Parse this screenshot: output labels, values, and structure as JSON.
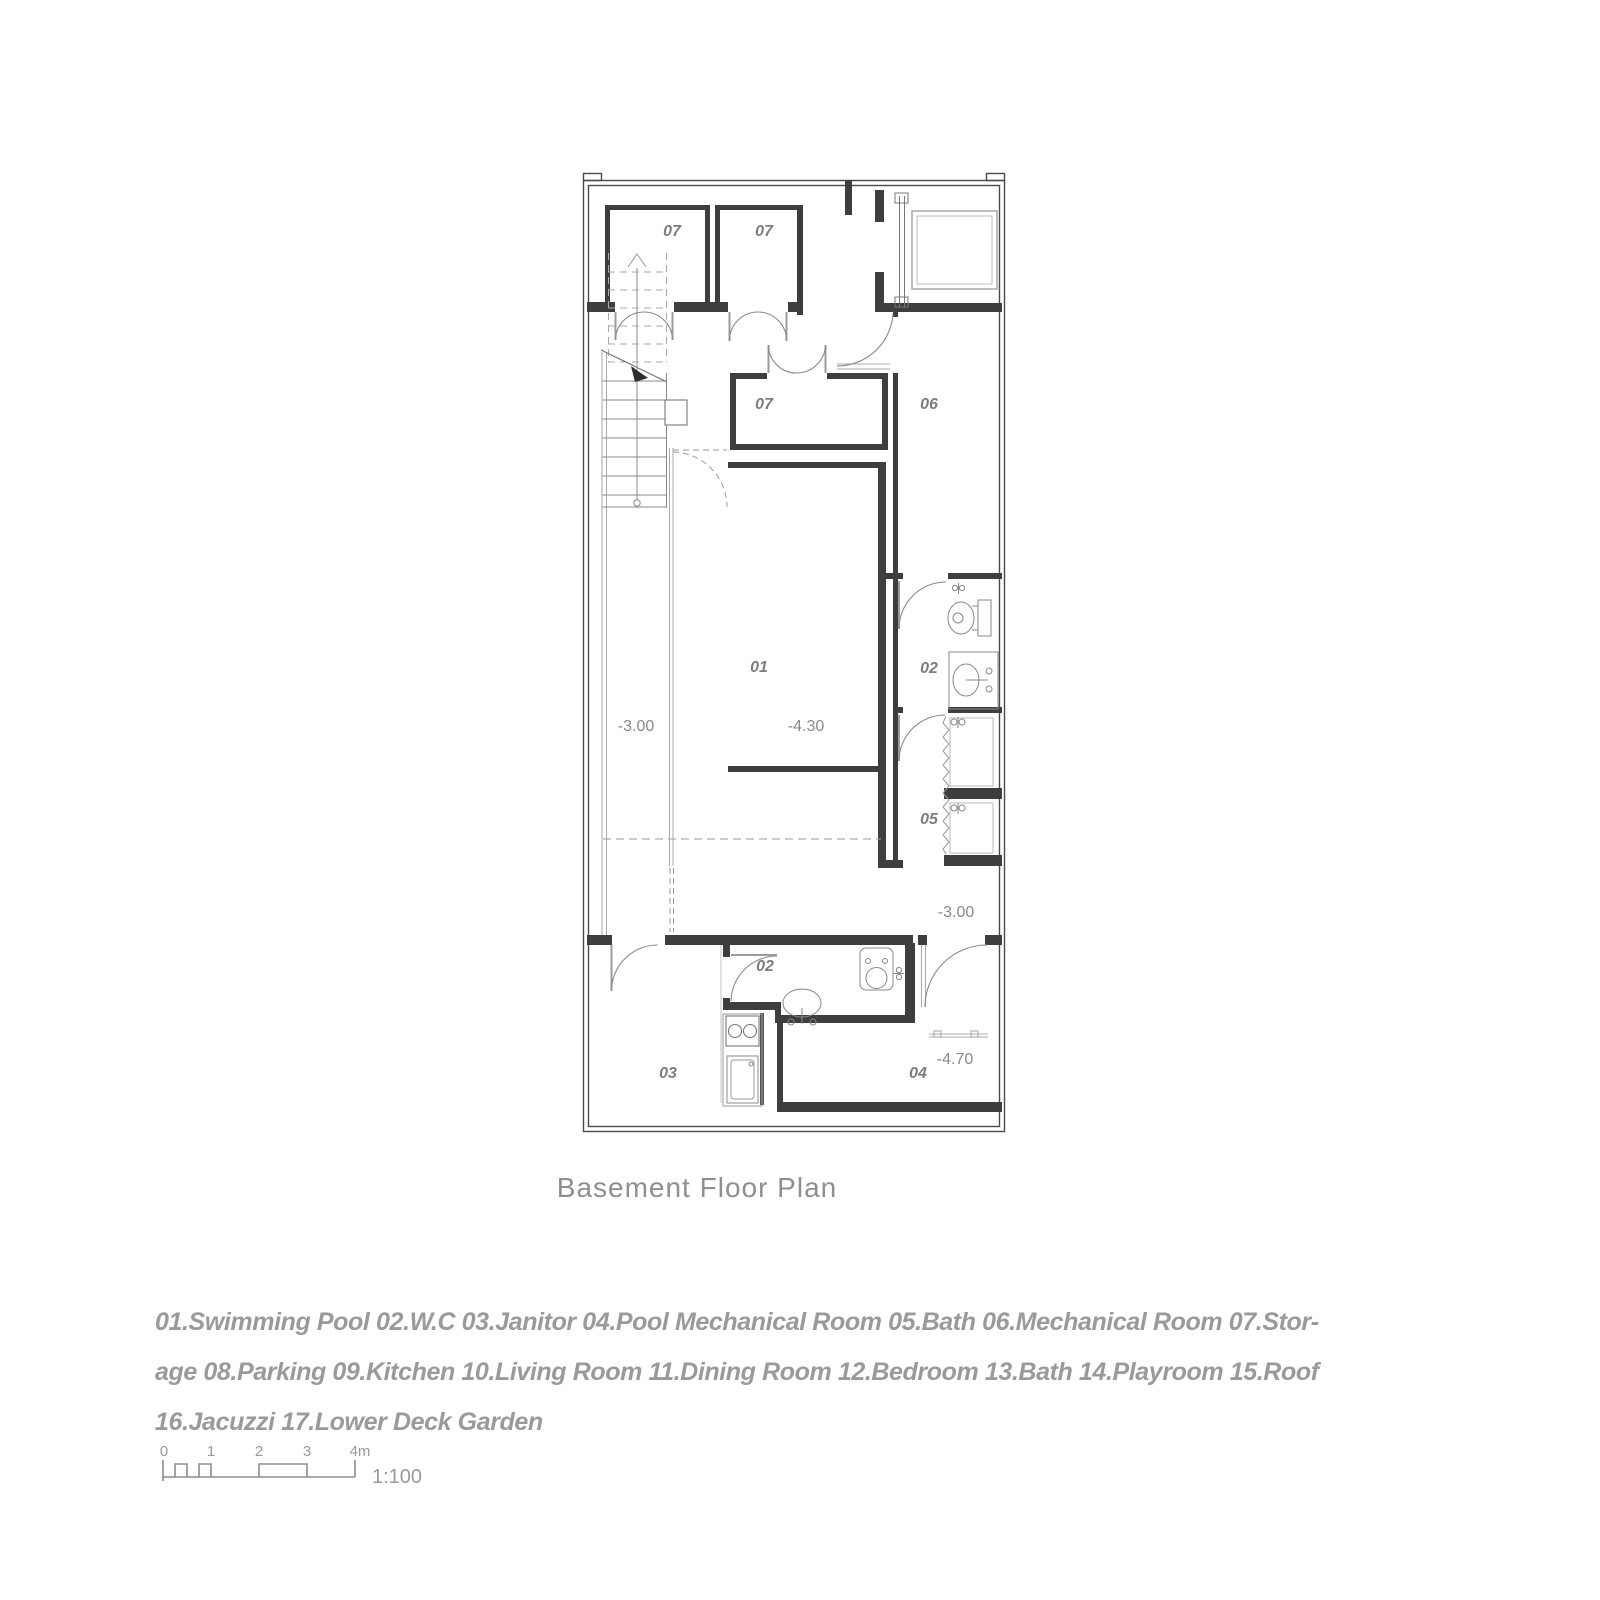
{
  "caption": {
    "title": "Basement Floor Plan"
  },
  "plan": {
    "rooms": [
      {
        "id": "storage-top-left",
        "label": "07"
      },
      {
        "id": "storage-top-mid",
        "label": "07"
      },
      {
        "id": "storage-middle",
        "label": "07"
      },
      {
        "id": "mechanical-room",
        "label": "06"
      },
      {
        "id": "swimming-pool",
        "label": "01"
      },
      {
        "id": "wc-upper",
        "label": "02"
      },
      {
        "id": "bath",
        "label": "05"
      },
      {
        "id": "wc-lower",
        "label": "02"
      },
      {
        "id": "janitor",
        "label": "03"
      },
      {
        "id": "pool-mechanical-room",
        "label": "04"
      }
    ],
    "levels": [
      {
        "id": "corridor-level",
        "label": "-3.00"
      },
      {
        "id": "pool-level",
        "label": "-4.30"
      },
      {
        "id": "deck-level",
        "label": "-3.00"
      },
      {
        "id": "pool-mech-level",
        "label": "-4.70"
      }
    ],
    "colors": {
      "wall": "#3e3e3e",
      "outer_wall": "#4a4a4a",
      "fixture": "#888888",
      "light_line": "#b5b5b5",
      "dashed": "#9a9a9a",
      "label": "#7d7d7d"
    }
  },
  "legend": {
    "lines": [
      "01.Swimming Pool 02.W.C 03.Janitor 04.Pool Mechanical Room 05.Bath 06.Mechanical Room 07.Stor-",
      "age 08.Parking 09.Kitchen 10.Living Room 11.Dining Room 12.Bedroom 13.Bath 14.Playroom 15.Roof",
      "16.Jacuzzi 17.Lower Deck Garden"
    ]
  },
  "scale": {
    "ticks": [
      "0",
      "1",
      "2",
      "3",
      "4m"
    ],
    "ratio": "1:100"
  }
}
